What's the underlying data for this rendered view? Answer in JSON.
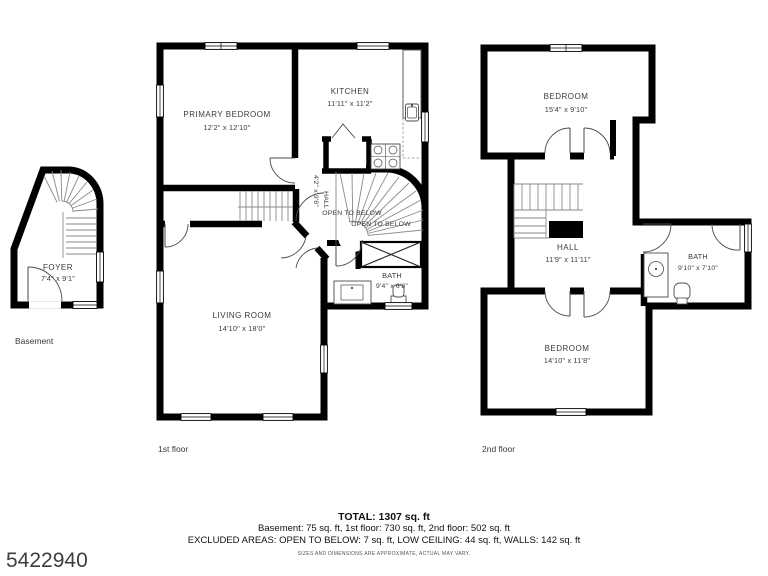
{
  "meta": {
    "listing_id": "5422940",
    "disclaimer": "SIZES AND DIMENSIONS ARE APPROXIMATE, ACTUAL MAY VARY."
  },
  "summary": {
    "total": "TOTAL: 1307 sq. ft",
    "by_floor": "Basement: 75 sq. ft, 1st floor: 730 sq. ft, 2nd floor: 502 sq. ft",
    "excluded": "EXCLUDED AREAS: OPEN TO BELOW: 7 sq. ft, LOW CEILING: 44 sq. ft, WALLS: 142 sq. ft"
  },
  "basement": {
    "caption": "Basement",
    "foyer": {
      "name": "FOYER",
      "dims": "7'4\" x 9'1\""
    }
  },
  "first_floor": {
    "caption": "1st floor",
    "primary_bedroom": {
      "name": "PRIMARY BEDROOM",
      "dims": "12'2\" x 12'10\""
    },
    "kitchen": {
      "name": "KITCHEN",
      "dims": "11'11\" x 11'2\""
    },
    "hall": {
      "name": "HALL",
      "dims": "4'2\" x 9'6\""
    },
    "open_to_below_1": "OPEN TO BELOW",
    "open_to_below_2": "OPEN TO BELOW",
    "bath": {
      "name": "BATH",
      "dims": "9'4\" x 6'8\""
    },
    "living_room": {
      "name": "LIVING ROOM",
      "dims": "14'10\" x 18'0\""
    }
  },
  "second_floor": {
    "caption": "2nd floor",
    "bedroom_top": {
      "name": "BEDROOM",
      "dims": "15'4\" x 9'10\""
    },
    "hall": {
      "name": "HALL",
      "dims": "11'9\" x 11'11\""
    },
    "bath": {
      "name": "BATH",
      "dims": "9'10\" x 7'10\""
    },
    "bedroom_bottom": {
      "name": "BEDROOM",
      "dims": "14'10\" x 11'8\""
    }
  }
}
